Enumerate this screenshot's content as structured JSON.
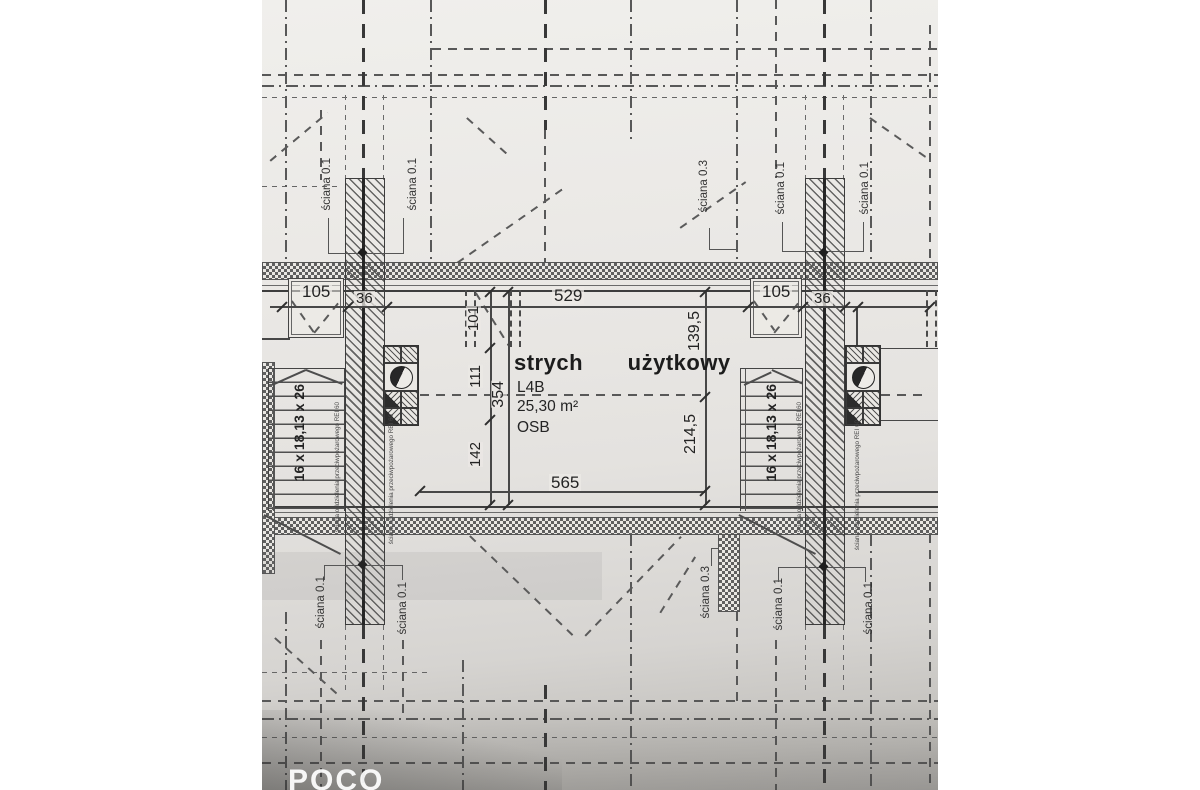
{
  "photo": {
    "watermark": "POCO"
  },
  "room": {
    "title": "strych użytkowy",
    "unit": "L4B",
    "area": "25,30 m²",
    "floor": "OSB"
  },
  "dims": {
    "w105": "105",
    "w36": "36",
    "w529": "529",
    "h101": "101",
    "h111": "111",
    "h142": "142",
    "h354": "354",
    "h139_5": "139,5",
    "h214_5": "214,5",
    "w565": "565"
  },
  "stairs": {
    "spec": "16 x 18,13 x 26"
  },
  "walls": {
    "thin": "ściana 0.1",
    "mid": "ściana 0.3",
    "fire_separation": "ściana oddzielenia przeciwpożarowego REI 60"
  }
}
